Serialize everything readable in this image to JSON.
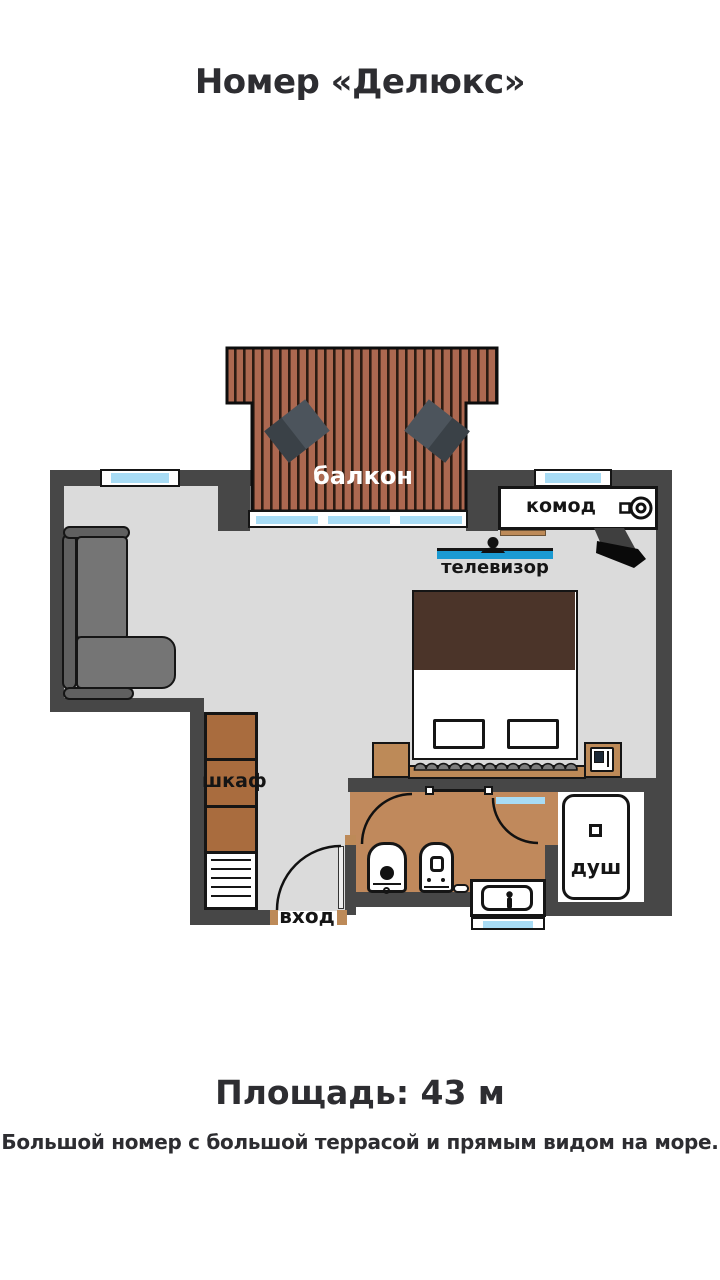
{
  "title": "Номер «Делюкс»",
  "plan": {
    "labels": {
      "balcony": "балкон",
      "dresser": "комод",
      "tv": "телевизор",
      "wardrobe": "шкаф",
      "entrance": "вход",
      "shower": "душ"
    }
  },
  "footer": {
    "area": "Площадь: 43 м",
    "description": "Большой номер с большой террасой и прямым видом на море."
  },
  "colors": {
    "wall": "#474747",
    "room_floor": "#DBDBDB",
    "bathroom_floor": "#C0895C",
    "deck_wood": "#AC6850",
    "deck_stripe": "#2B1B12",
    "wardrobe_wood": "#A96C3E",
    "furniture_wood": "#BD8A58",
    "bed_blanket": "#4B3429",
    "window_glass": "#A8DCF5",
    "tv_screen": "#1B9AD2",
    "sofa_gray": "#757575",
    "text": "#2E2E33"
  }
}
